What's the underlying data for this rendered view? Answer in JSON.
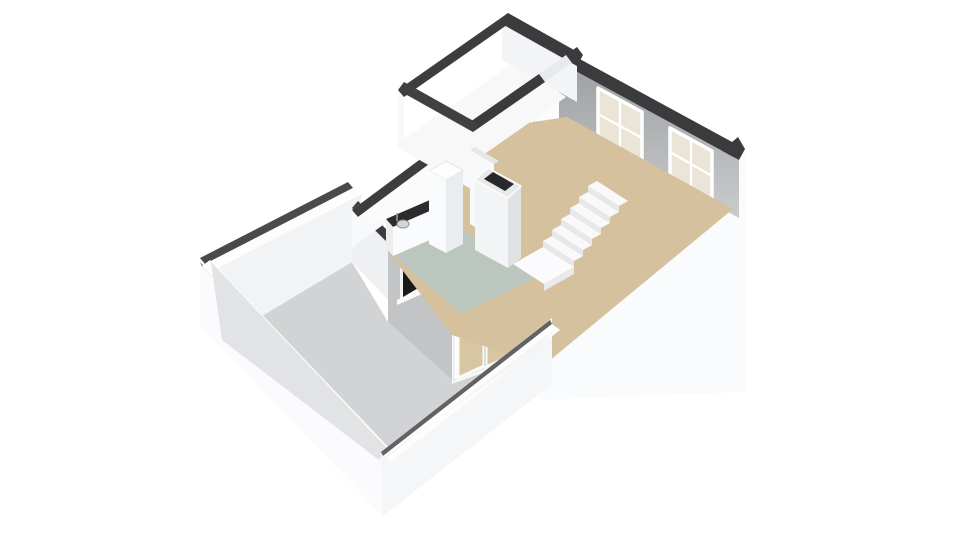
{
  "canvas": {
    "width": 960,
    "height": 540,
    "background": "#ffffff",
    "view": "isometric-3d-floorplan"
  },
  "palette": {
    "wall_cap_dark": "#3b3b3d",
    "wall_white": "#fafafb",
    "wall_bright": "#ffffff",
    "wall_shade": "#ececee",
    "exterior_gray": "#c3c4c6",
    "interior_gray_top": "#9da0a2",
    "interior_gray_bottom": "#c9cbcd",
    "floor_living_beige": "#d6c19e",
    "floor_kitchen_sage": "#bbc7be",
    "floor_terrace_gray": "#d2d3d5",
    "glass_cream": "#ebe5d7",
    "glass_dark": "#19191b",
    "counter_dark": "#2c2c2e",
    "stair_white": "#f9f9fb",
    "stair_riser": "#e7e8ea",
    "door_glass_beige": "#d8c5a1"
  },
  "scene": {
    "type": "floorplan-3d",
    "rooms": [
      {
        "name": "living-room",
        "floor_color": "#d6c19e",
        "features": [
          "two-sash-windows",
          "staircase",
          "chimney-column",
          "door-to-small-room"
        ]
      },
      {
        "name": "kitchen",
        "floor_color": "#bbc7be",
        "features": [
          "counter-with-sink",
          "tall-cabinet",
          "small-dark-window",
          "french-doors"
        ]
      },
      {
        "name": "small-room",
        "floor_color": "#f8f8f9",
        "features": [
          "open-doorway"
        ]
      },
      {
        "name": "hallway-strip",
        "floor_color": "#fbfbfc",
        "features": [
          "step"
        ]
      },
      {
        "name": "terrace",
        "floor_color": "#d2d3d5",
        "features": [
          "low-parapet-walls"
        ]
      }
    ]
  },
  "shapes": [
    {
      "name": "terrace-floor",
      "type": "polygon",
      "points": "222,340 352,262 388,322 452,380 540,347 379,460",
      "fill": "#d2d3d5"
    },
    {
      "name": "terrace-nw-wall-capline",
      "type": "polygon",
      "points": "200,258 348,182 353,188 205,264",
      "fill": "#4a4a4c"
    },
    {
      "name": "terrace-nw-wall-top",
      "type": "polygon",
      "points": "205,264 353,188 362,194 214,270",
      "fill": "#fdfdfd"
    },
    {
      "name": "terrace-nw-wall-inner",
      "type": "polygon",
      "points": "214,270 362,194 352,262 222,340",
      "fill": "#f2f3f5"
    },
    {
      "name": "unit-se-wall-skirt",
      "type": "polygon",
      "points": "745,149 540,322 540,400 745,392",
      "fill": "#fafbfc"
    },
    {
      "name": "unit-se-wall-cap",
      "type": "polygon",
      "points": "745,149 540,322 533,311 738,137",
      "fill": "#3b3b3d"
    },
    {
      "name": "doors-wall-face",
      "type": "polygon",
      "points": "452,288 540,322 540,352 452,384",
      "fill": "#f6f7f9"
    },
    {
      "name": "french-doors-frame",
      "type": "polygon",
      "points": "454,300 516,268 516,356 454,380",
      "fill": "#ffffff",
      "stroke": "#e3e3e5",
      "stroke_width": 1
    },
    {
      "name": "french-door-leaf-left",
      "type": "polygon",
      "points": "458,304 484,291 484,366 458,378",
      "fill": "#d8c5a1",
      "stroke": "#fafafa",
      "stroke_width": 3
    },
    {
      "name": "french-door-leaf-right",
      "type": "polygon",
      "points": "486,290 512,277 512,355 486,367",
      "fill": "#d8c5a1",
      "stroke": "#fafafa",
      "stroke_width": 3
    },
    {
      "name": "french-doors-seam",
      "type": "line",
      "x1": 485,
      "y1": 291,
      "x2": 485,
      "y2": 366,
      "stroke": "#bdbdbf",
      "stroke_width": 1
    },
    {
      "name": "doors-wall-cap",
      "type": "polygon",
      "points": "452,288 540,322 544,312 456,278",
      "fill": "#3a3a3c"
    },
    {
      "name": "kitchen-sw-wall-face",
      "type": "polygon",
      "points": "452,288 388,243 388,322 452,380",
      "fill": "#c3c4c6"
    },
    {
      "name": "kitchen-sw-window-frame",
      "type": "polygon",
      "points": "400,264 428,249 428,287 400,302",
      "fill": "#f2f2f4"
    },
    {
      "name": "kitchen-sw-window-glass",
      "type": "polygon",
      "points": "403,267 425,254 425,284 403,297",
      "fill": "#19191b"
    },
    {
      "name": "kitchen-sw-window-sill",
      "type": "polygon",
      "points": "397,300 431,285 431,290 397,305",
      "fill": "#fafafa"
    },
    {
      "name": "kitchen-sw-wall-cap",
      "type": "polygon",
      "points": "452,288 388,243 393,236 457,281",
      "fill": "#39393b"
    },
    {
      "name": "nw-tip-wall-face",
      "type": "polygon",
      "points": "388,243 352,208 352,262 388,300",
      "fill": "#eff0f2"
    },
    {
      "name": "nw-tip-wall-cap",
      "type": "polygon",
      "points": "388,243 352,208 358,201 393,236",
      "fill": "#3c3c3e"
    },
    {
      "name": "nw-exterior-wall-face",
      "type": "polygon",
      "points": "352,210 473,120 473,158 352,248",
      "fill": "#f8f9fa"
    },
    {
      "name": "nw-exterior-wall-cap",
      "type": "polygon",
      "points": "352,210 473,120 479,127 358,217",
      "fill": "#3d3d3f"
    },
    {
      "name": "hallway-floor",
      "type": "polygon",
      "points": "358,217 479,127 446,193 386,219",
      "fill": "#fbfbfc"
    },
    {
      "name": "hallway-step-top",
      "type": "polygon",
      "points": "416,210 437,196 449,205 428,219",
      "fill": "#ffffff",
      "stroke": "#e6e6e8",
      "stroke_width": 1
    },
    {
      "name": "hallway-step-front",
      "type": "polygon",
      "points": "428,219 449,205 449,219 428,233",
      "fill": "#e8e8ea"
    },
    {
      "name": "hallway-step-side",
      "type": "polygon",
      "points": "416,210 428,219 428,233 416,224",
      "fill": "#f1f1f3"
    },
    {
      "name": "living-nw-wall-face",
      "type": "polygon",
      "points": "559,62 479,124 479,168 559,106",
      "fill": "#fefefe"
    },
    {
      "name": "small-room-door",
      "type": "polygon",
      "points": "534,82 560,63 560,120 534,139",
      "fill": "#fcfcfd",
      "stroke": "#dcdcde",
      "stroke_width": 1
    },
    {
      "name": "small-room-door-pane",
      "type": "polygon",
      "points": "541,86 553,77 553,92 541,101",
      "fill": "#efefed"
    },
    {
      "name": "living-ne-wall-interior",
      "type": "polygon",
      "points": "559,62 739,160 739,218 559,120",
      "fill": "url(#gNE)"
    },
    {
      "name": "ne-window-1-glass",
      "type": "polygon",
      "points": "598,88 642,112 642,164 598,140",
      "fill": "#ebe5d7",
      "stroke": "#ffffff",
      "stroke_width": 3.5
    },
    {
      "name": "ne-window-1-muntin-v",
      "type": "line",
      "x1": 620,
      "y1": 100,
      "x2": 620,
      "y2": 152,
      "stroke": "#ffffff",
      "stroke_width": 2.2
    },
    {
      "name": "ne-window-1-muntin-h",
      "type": "line",
      "x1": 598,
      "y1": 114,
      "x2": 642,
      "y2": 138,
      "stroke": "#ffffff",
      "stroke_width": 2.2
    },
    {
      "name": "ne-window-1-sill",
      "type": "polygon",
      "points": "595,140 645,167 645,172 595,145",
      "fill": "#fbfbfd"
    },
    {
      "name": "ne-window-2-glass",
      "type": "polygon",
      "points": "670,128 712,151 712,201 670,178",
      "fill": "#ebe5d7",
      "stroke": "#ffffff",
      "stroke_width": 3.5
    },
    {
      "name": "ne-window-2-muntin-v",
      "type": "line",
      "x1": 691,
      "y1": 140,
      "x2": 691,
      "y2": 189,
      "stroke": "#ffffff",
      "stroke_width": 2.2
    },
    {
      "name": "ne-window-2-muntin-h",
      "type": "line",
      "x1": 670,
      "y1": 152,
      "x2": 712,
      "y2": 176,
      "stroke": "#ffffff",
      "stroke_width": 2.2
    },
    {
      "name": "ne-window-2-sill",
      "type": "polygon",
      "points": "667,178 715,204 715,209 667,183",
      "fill": "#fbfbfd"
    },
    {
      "name": "living-ne-wall-cap",
      "type": "polygon",
      "points": "565,51 745,149 739,160 559,62",
      "fill": "#3b3b3d"
    },
    {
      "name": "living-room-floor",
      "type": "polygon",
      "points": "567,117 733,209 543,366 452,335 390,254 446,192 473,131",
      "fill": "#d6c19e"
    },
    {
      "name": "kitchen-floor",
      "type": "polygon",
      "points": "440,214 535,278 462,314 392,254",
      "fill": "#bbc7be"
    },
    {
      "name": "small-room-sw-ext-face",
      "type": "polygon",
      "points": "398,90 473,132 473,190 398,148",
      "fill": "#f7f8fa"
    },
    {
      "name": "small-room-floor",
      "type": "polygon",
      "points": "404,139 514,62 566,97 456,174",
      "fill": "#f8f8f9"
    },
    {
      "name": "small-room-nw-wall-inner",
      "type": "polygon",
      "points": "404,97 514,20 514,62 404,139",
      "fill": "#ffffff"
    },
    {
      "name": "small-room-ne-wall-inner",
      "type": "polygon",
      "points": "502,24 577,66 577,102 502,60",
      "fill": "#f3f4f6"
    },
    {
      "name": "small-room-nw-cap",
      "type": "polygon",
      "points": "398,90 508,13 514,20 404,97",
      "fill": "#3d3d3f"
    },
    {
      "name": "small-room-ne-cap",
      "type": "polygon",
      "points": "508,13 583,55 577,66 502,24",
      "fill": "#3b3b3d"
    },
    {
      "name": "small-room-se-cap-a",
      "type": "polygon",
      "points": "583,55 572,63 566,55 577,47",
      "fill": "#3b3b3d"
    },
    {
      "name": "small-room-doorway-jamb",
      "type": "polygon",
      "points": "572,63 545,82 539,74 566,55",
      "fill": "#e9eaec"
    },
    {
      "name": "small-room-se-cap-b",
      "type": "polygon",
      "points": "545,82 473,132 467,124 539,74",
      "fill": "#3b3b3d"
    },
    {
      "name": "small-room-sw-cap",
      "type": "polygon",
      "points": "473,132 398,90 404,82 479,124",
      "fill": "#403f41"
    },
    {
      "name": "kitchen-counter-top",
      "type": "polygon",
      "points": "386,219 446,193 453,201 393,227",
      "fill": "#2c2c2e"
    },
    {
      "name": "kitchen-counter-front",
      "type": "polygon",
      "points": "393,227 453,201 453,230 393,256",
      "fill": "#fafbfc"
    },
    {
      "name": "kitchen-counter-side",
      "type": "polygon",
      "points": "386,219 393,227 393,256 386,248",
      "fill": "#eceded"
    },
    {
      "name": "kitchen-sink",
      "type": "ellipse",
      "cx": 403,
      "cy": 224,
      "rx": 6,
      "ry": 4,
      "fill": "#d4d5d7",
      "stroke": "#929294",
      "stroke_width": 1
    },
    {
      "name": "kitchen-faucet",
      "type": "line",
      "x1": 397,
      "y1": 213,
      "x2": 397,
      "y2": 221,
      "stroke": "#a0a0a2",
      "stroke_width": 1.5
    },
    {
      "name": "fridge-top",
      "type": "polygon",
      "points": "429,171 446,161 463,170 446,180",
      "fill": "#fcfdfd",
      "stroke": "#e8e8ea",
      "stroke_width": 1
    },
    {
      "name": "fridge-front",
      "type": "polygon",
      "points": "429,171 446,180 446,253 429,244",
      "fill": "#f9fafb"
    },
    {
      "name": "fridge-side",
      "type": "polygon",
      "points": "446,180 463,170 463,244 446,253",
      "fill": "#ebecee"
    },
    {
      "name": "chimney-back-slab-top",
      "type": "polygon",
      "points": "470,150 494,164 499,161 475,147",
      "fill": "#e6e7e9"
    },
    {
      "name": "chimney-back-slab-face",
      "type": "polygon",
      "points": "470,150 494,164 494,238 470,224",
      "fill": "#f8f9fa"
    },
    {
      "name": "chimney-column-sw-face",
      "type": "polygon",
      "points": "475,180 508,198 508,268 475,250",
      "fill": "#f3f4f6"
    },
    {
      "name": "chimney-column-se-face",
      "type": "polygon",
      "points": "508,198 521,186 521,258 508,268",
      "fill": "#e1e2e4"
    },
    {
      "name": "chimney-column-top-ring",
      "type": "polygon",
      "points": "488,168 521,186 508,198 475,180",
      "fill": "#e8e9eb",
      "stroke": "#fdfdfd",
      "stroke_width": 1.5
    },
    {
      "name": "chimney-column-opening",
      "type": "polygon",
      "points": "493,172 514,184 505,191 484,179",
      "fill": "#29292b"
    },
    {
      "name": "stairs-landing-top",
      "type": "polygon",
      "points": "513,264 543,247 574,267 544,284",
      "fill": "#fbfbfd"
    },
    {
      "name": "stairs-landing-front",
      "type": "polygon",
      "points": "544,284 574,267 574,274 544,291",
      "fill": "#e9eaec"
    },
    {
      "name": "stairs-riser-1",
      "type": "polygon",
      "points": "543,247 574,267 574,261 543,241",
      "fill": "#e7e8ea"
    },
    {
      "name": "stairs-tread-1",
      "type": "polygon",
      "points": "543,241 574,261 583,256 552,236",
      "fill": "#f9f9fb"
    },
    {
      "name": "stairs-riser-2",
      "type": "polygon",
      "points": "552,236 583,256 583,250 552,230",
      "fill": "#e7e8ea"
    },
    {
      "name": "stairs-tread-2",
      "type": "polygon",
      "points": "552,230 583,250 592,245 561,225",
      "fill": "#f9f9fb"
    },
    {
      "name": "stairs-riser-3",
      "type": "polygon",
      "points": "561,225 592,245 592,239 561,219",
      "fill": "#e7e8ea"
    },
    {
      "name": "stairs-tread-3",
      "type": "polygon",
      "points": "561,219 592,239 601,234 570,214",
      "fill": "#f9f9fb"
    },
    {
      "name": "stairs-riser-4",
      "type": "polygon",
      "points": "570,214 601,234 601,228 570,208",
      "fill": "#e7e8ea"
    },
    {
      "name": "stairs-tread-4",
      "type": "polygon",
      "points": "570,208 601,228 610,223 579,203",
      "fill": "#f9f9fb"
    },
    {
      "name": "stairs-riser-5",
      "type": "polygon",
      "points": "579,203 610,223 610,217 579,197",
      "fill": "#e7e8ea"
    },
    {
      "name": "stairs-tread-5",
      "type": "polygon",
      "points": "579,197 610,217 619,212 588,192",
      "fill": "#f9f9fb"
    },
    {
      "name": "stairs-riser-6",
      "type": "polygon",
      "points": "588,192 619,212 619,206 588,186",
      "fill": "#e7e8ea"
    },
    {
      "name": "stairs-tread-6",
      "type": "polygon",
      "points": "588,186 619,206 628,201 597,181",
      "fill": "#f9f9fb"
    },
    {
      "name": "terrace-sw-wall-skirt",
      "type": "polygon",
      "points": "200,262 381,452 383,516 200,326",
      "fill": "#fbfbfd"
    },
    {
      "name": "terrace-sw-wall-capline",
      "type": "polygon",
      "points": "200,262 381,452 383,456 202,266",
      "fill": "#58585a"
    },
    {
      "name": "terrace-sw-wall-top",
      "type": "polygon",
      "points": "202,266 383,456 391,450 210,260",
      "fill": "#fefefe"
    },
    {
      "name": "terrace-sw-wall-inner",
      "type": "polygon",
      "points": "211,262 387,448 379,460 222,340",
      "fill": "#e2e3e5"
    },
    {
      "name": "terrace-se-wall-skirt",
      "type": "polygon",
      "points": "381,452 552,318 552,384 383,516",
      "fill": "#f5f6f8"
    },
    {
      "name": "terrace-se-wall-capline",
      "type": "polygon",
      "points": "381,452 550,320 552,324 383,456",
      "fill": "#626264"
    },
    {
      "name": "terrace-se-wall-top",
      "type": "polygon",
      "points": "383,456 552,324 560,330 391,462",
      "fill": "#fdfdfd"
    },
    {
      "name": "terrace-se-wall-inner",
      "type": "polygon",
      "points": "389,456 556,328 540,347 379,460",
      "fill": "#f4f5f7"
    }
  ]
}
